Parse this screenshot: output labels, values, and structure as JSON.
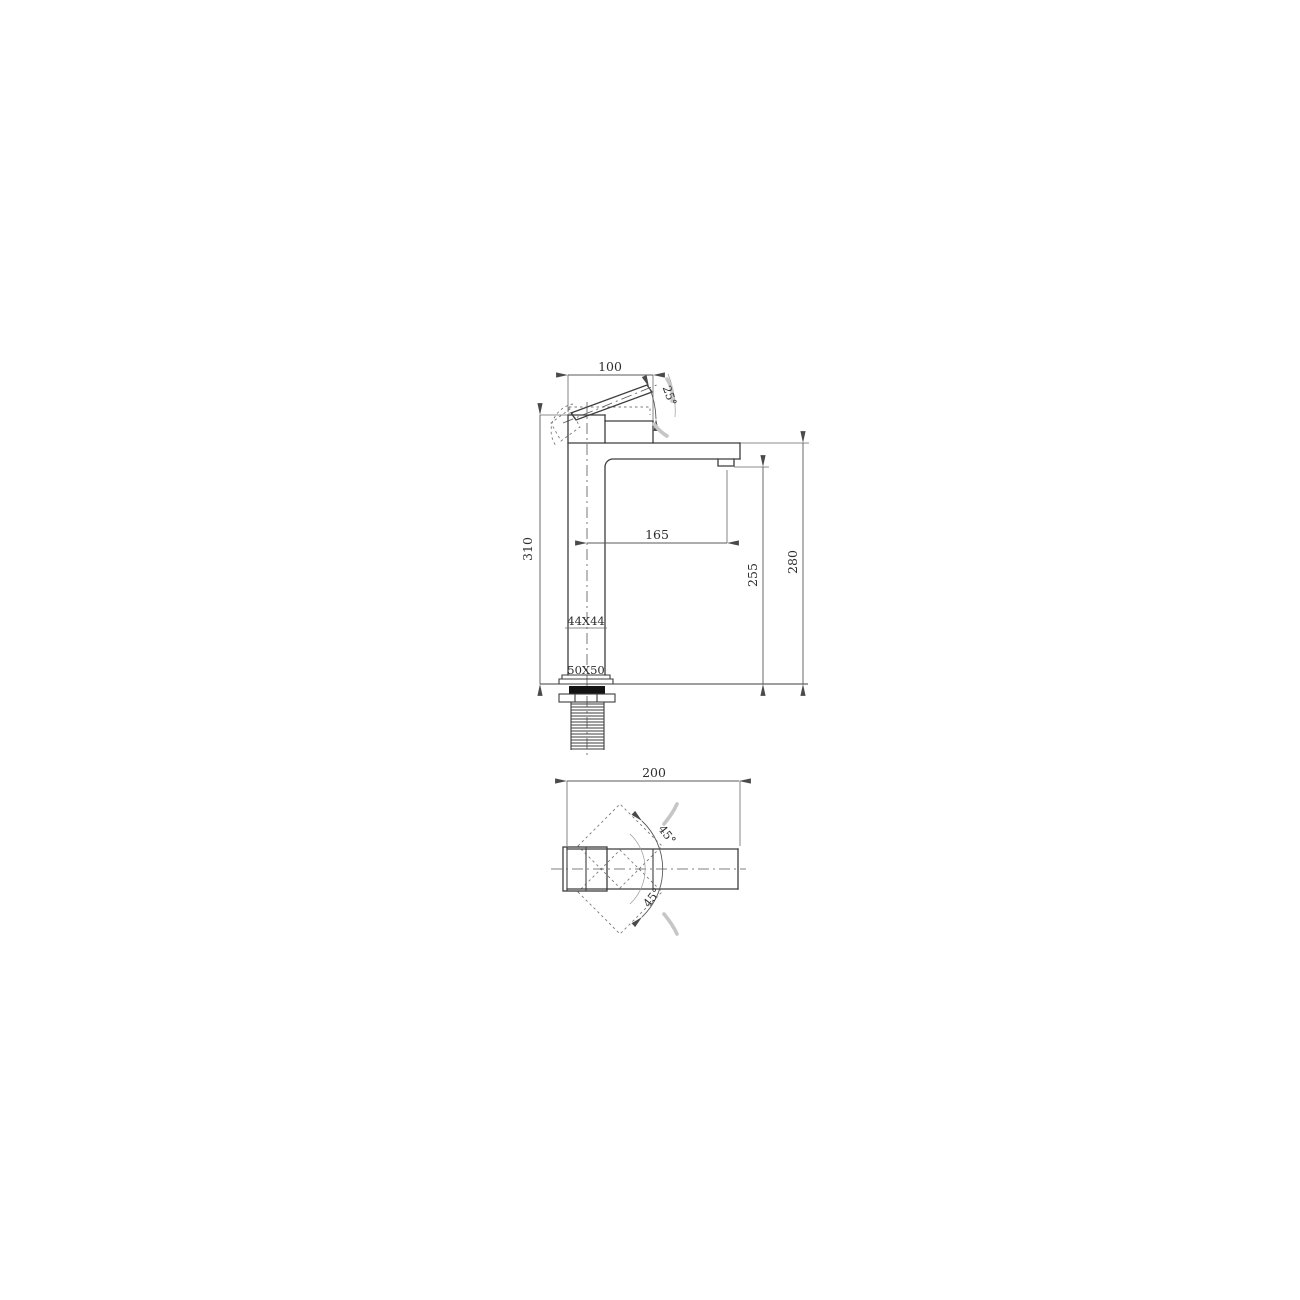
{
  "drawing_title": "basin mixer tap dimension drawing",
  "front_view": {
    "handle_length": "100",
    "handle_angle": "25°",
    "total_height": "310",
    "spout_reach": "165",
    "outlet_height": "255",
    "spout_top_height": "280",
    "body_section": "44X44",
    "base_section": "50X50"
  },
  "plan_view": {
    "overall_length": "200",
    "handle_swing_upper": "45°",
    "handle_swing_lower": "45°"
  },
  "colors": {
    "line": "#3d3d3d",
    "dim": "#5a5a5a",
    "text": "#2e2e2e",
    "gasket": "#141414",
    "motion": "#c6c6c6",
    "background": "#ffffff"
  }
}
